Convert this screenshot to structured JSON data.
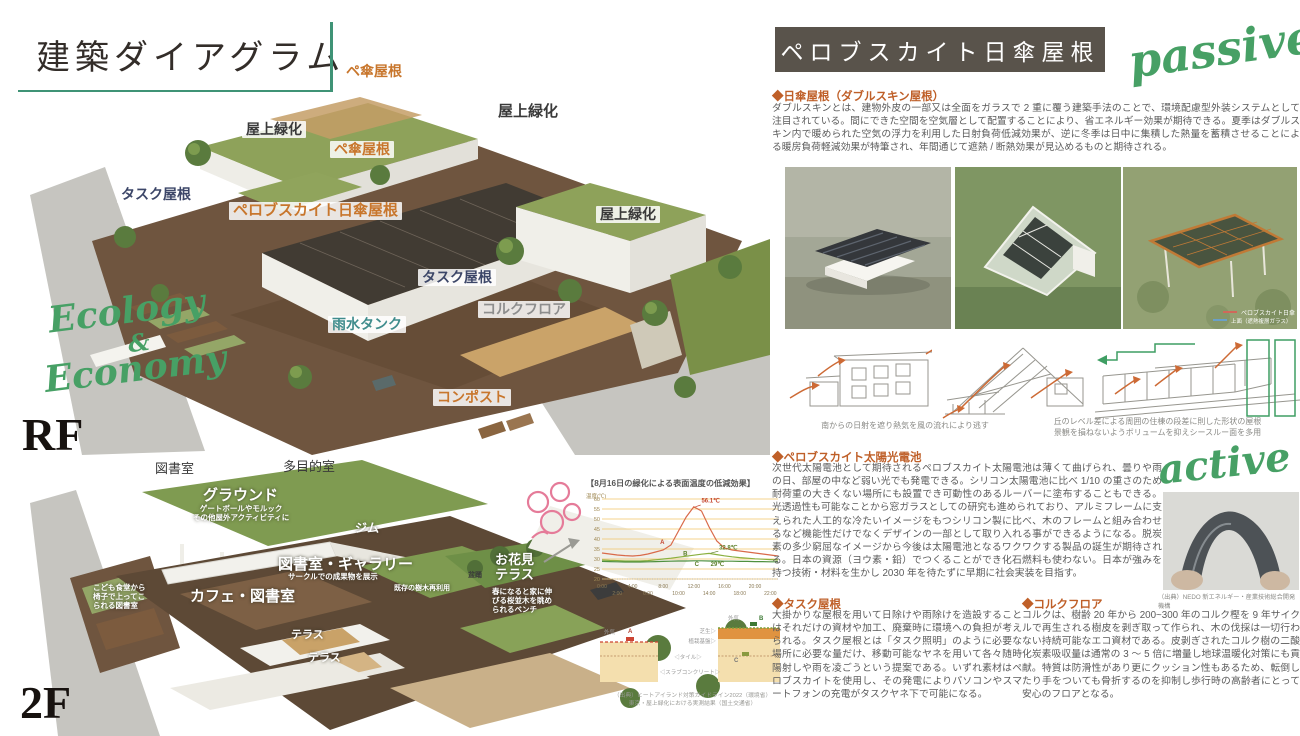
{
  "left_panel": {
    "title": "建築ダイアグラム",
    "floor_rf": "RF",
    "floor_2f": "2F",
    "script": {
      "line1": "Ecology",
      "amp": "&",
      "line2": "Economy"
    },
    "rf_labels": [
      {
        "text": "ペ傘屋根"
      },
      {
        "text": "屋上緑化"
      },
      {
        "text": "屋上緑化"
      },
      {
        "text": "ペ傘屋根"
      },
      {
        "text": "タスク屋根"
      },
      {
        "text": "ペロブスカイト日傘屋根"
      },
      {
        "text": "屋上緑化"
      },
      {
        "text": "タスク屋根"
      },
      {
        "text": "コルクフロア"
      },
      {
        "text": "雨水タンク"
      },
      {
        "text": "コンポスト"
      }
    ],
    "f2_labels": [
      {
        "text": "図書室"
      },
      {
        "text": "多目的室"
      },
      {
        "text": "グラウンド"
      },
      {
        "text": "ゲートボールやモルック\nその他屋外アクティビティに"
      },
      {
        "text": "ジム"
      },
      {
        "text": "図書室・ギャラリー"
      },
      {
        "text": "サークルでの成果物を展示"
      },
      {
        "text": "こども食堂から\n椅子で上ってこ\nられる図書室"
      },
      {
        "text": "カフェ・図書室"
      },
      {
        "text": "既存の樹木再利用"
      },
      {
        "text": "盆踊"
      },
      {
        "text": "お花見\nテラス"
      },
      {
        "text": "春になると家に伸\nびる桜並木を眺め\nられるベンチ"
      },
      {
        "text": "テラス"
      },
      {
        "text": "テラス"
      }
    ]
  },
  "right_panel": {
    "banner": "ペロブスカイト日傘屋根",
    "passive": "passive",
    "active": "active",
    "sections": [
      {
        "heading": "◆日傘屋根（ダブルスキン屋根）",
        "body": "ダブルスキンとは、建物外皮の一部又は全面をガラスで 2 重に覆う建築手法のことで、環境配慮型外装システムとして注目されている。間にできた空間を空気層として配置することにより、省エネルギー効果が期待できる。夏季はダブルスキン内で暖められた空気の浮力を利用した日射負荷低減効果が、逆に冬季は日中に集積した熱量を蓄積させることによる暖房負荷軽減効果が特筆され、年間通じて遮熱 / 断熱効果が見込めるものと期待される。"
      },
      {
        "heading": "◆ペロブスカイト太陽光電池",
        "body": "次世代太陽電池として期待されるペロブスカイト太陽電池は薄くて曲げられ、曇りや雨の日、部屋の中など弱い光でも発電できる。シリコン太陽電池に比べ 1/10 の重さのため耐荷重の大きくない場所にも設置でき可動性のあるルーバーに塗布することもできる。光透過性も可能なことから窓ガラスとしての研究も進められており、アルミフレームに支えられた人工的な冷たいイメージをもつシリコン製に比べ、木のフレームと組み合わせるなど機能性だけでなくデザインの一部として取り入れる事ができるようになる。脱炭素の多少窮屈なイメージから今後は太陽電池となるワクワクする製品の誕生が期待される。日本の資源（ヨウ素・鉛）でつくることができ化石燃料も使わない。日本が強みを持つ技術・材料を生かし 2030 年を待たずに早期に社会実装を目指す。"
      },
      {
        "heading": "◆タスク屋根",
        "body": "大掛かりな屋根を用いて日除けや雨除けを造設することはそれだけの資材や加工、廃棄時に環境への負担が考えられる。タスク屋根とは「タスク照明」のように必要な場所に必要な量だけ、移動可能なヤネを用いて各々随時陽射しや雨を凌ごうという提案である。いずれ素材はペロブスカイトを使用し、その発電によりパソコンやスマートフォンの充電がタスクヤネ下で可能になる。"
      },
      {
        "heading": "◆コルクフロア",
        "body": "コルクは、樹齢 20 年から 200~300 年のコルク樫を 9 年サイクルで再生される樹皮を剥ぎ取って作られ、木の伐採は一切行わない持続可能なエコ資材である。皮剥ぎされたコルク樹の二酸化炭素吸収量は通常の 3 ～ 5 倍に増量し地球温暖化対策にも貢献。特質は防滑性があり更にクッション性もあるため、転倒したり手をついても骨折するのを抑制し歩行時の高齢者にとって安心のフロアとなる。"
      }
    ],
    "photo3_caption": [
      "ペロブスカイト日傘",
      "上面（遮熱複層ガラス）"
    ],
    "sketch_caption_left": "南からの日射を遮り熱気を風の流れにより逃す",
    "sketch_caption_right": "丘のレベル差による周囲の住棟の段差に則した形状の屋根\n景観を損ねないようボリュームを抑えシースルー面を多用",
    "nedo_caption": "（出典）NEDO 新エネルギー・産業技術総合開発機構"
  },
  "chart_data": {
    "type": "line",
    "title": "【8月16日の緑化による表面温度の低減効果】",
    "ylabel": "温度(℃)",
    "ylim": [
      20,
      60
    ],
    "yticks": [
      20,
      25,
      30,
      35,
      40,
      45,
      50,
      55,
      60
    ],
    "xtick_row1": [
      "0:00",
      "4:00",
      "8:00",
      "12:00",
      "16:00",
      "20:00"
    ],
    "xtick_row2": [
      "2:00",
      "6:00",
      "10:00",
      "14:00",
      "18:00",
      "22:00"
    ],
    "grid": true,
    "series": [
      {
        "name": "A",
        "color": "#d96a4a",
        "label_color": "#c4452f",
        "letter_pos": [
          7.6,
          37.5
        ],
        "annotation": {
          "text": "56.1℃",
          "pos": [
            13.0,
            58.2
          ],
          "leader": [
            [
              12.2,
              56.1
            ],
            [
              12.9,
              57.0
            ]
          ]
        },
        "values": [
          33,
          32.5,
          32,
          31.7,
          31.5,
          31.8,
          32.5,
          33.5,
          34.5,
          37,
          44,
          51,
          56.1,
          54,
          46,
          39,
          35.5,
          34.5,
          34,
          33.5,
          33,
          32.5,
          32,
          31.5
        ]
      },
      {
        "name": "B",
        "color": "#8ab03e",
        "label_color": "#5c7f2a",
        "letter_pos": [
          10.6,
          31.8
        ],
        "annotation": {
          "text": "32.8℃",
          "pos": [
            15.3,
            34.8
          ],
          "leader": [
            [
              14.2,
              32.9
            ],
            [
              15.2,
              33.9
            ]
          ]
        },
        "values": [
          29.5,
          29.3,
          29.2,
          29,
          29,
          29,
          29.2,
          29.6,
          30,
          30.4,
          30.9,
          31.4,
          31.9,
          32.4,
          32.8,
          32.2,
          31.6,
          31.1,
          30.7,
          30.4,
          30.1,
          29.9,
          29.7,
          29.5
        ]
      },
      {
        "name": "C",
        "color": "#4f9140",
        "label_color": "#5c7f2a",
        "letter_pos": [
          12.1,
          26.4
        ],
        "annotation": {
          "text": "29℃",
          "pos": [
            14.2,
            26.4
          ],
          "leader": null
        },
        "values": [
          28.8,
          28.7,
          28.6,
          28.5,
          28.5,
          28.5,
          28.6,
          28.7,
          28.8,
          28.9,
          29,
          29,
          29.1,
          29.1,
          29,
          29,
          28.9,
          28.9,
          28.8,
          28.8,
          28.7,
          28.7,
          28.6,
          28.6
        ]
      }
    ]
  },
  "cross_section": {
    "labels": {
      "outside_air_left": "外気",
      "outside_air_right": "外気",
      "a": "A",
      "b": "B",
      "c": "C",
      "turf": "芝生▷",
      "base": "植栽基盤▷",
      "tile": "◁タイル▷",
      "slab": "◁スラブコンクリート▷"
    },
    "caption": "（出典）ヒートアイランド対策ガイドライン2022（環境省）\n東京・屋上緑化における実測結果（国土交通省）"
  },
  "colors": {
    "accent_green": "#3f9376",
    "script_green": "#47a065",
    "banner_bg": "#59534b",
    "heading_orange": "#bf5f28"
  }
}
